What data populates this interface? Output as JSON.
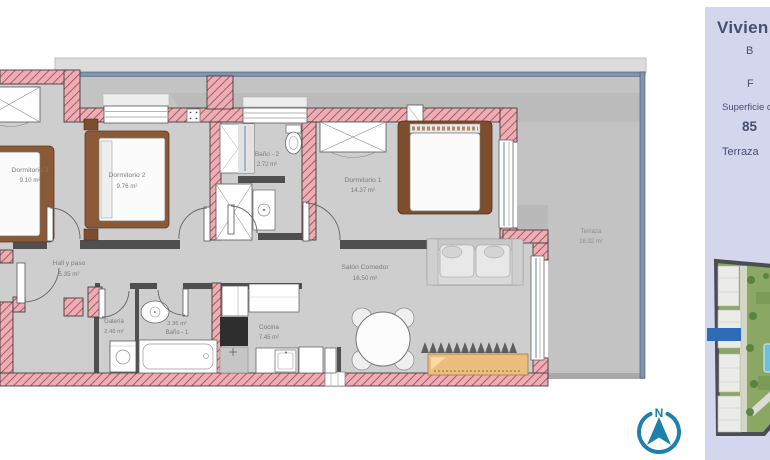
{
  "panel": {
    "title": "Vivien",
    "row1": "B",
    "row2": "F",
    "row3": "Superficie c",
    "row4": "85",
    "row5": "Terraza"
  },
  "compass": {
    "north_label": "N"
  },
  "rooms": {
    "dormitorio3": {
      "name": "Dormitorio 3",
      "area": "9.10 m²"
    },
    "dormitorio2": {
      "name": "Dormitorio 2",
      "area": "9.76 m²"
    },
    "bano2": {
      "name": "Baño - 2",
      "area": "2.72 m²"
    },
    "dormitorio1": {
      "name": "Dormitorio 1",
      "area": "14.37 m²"
    },
    "hall": {
      "name": "Hall y paso",
      "area": "5.35 m²"
    },
    "galeria": {
      "name": "Galería",
      "area": "2.46 m²"
    },
    "bano1": {
      "name": "Baño - 1",
      "area": "3.36 m²"
    },
    "cocina": {
      "name": "Cocina",
      "area": "7.45 m²"
    },
    "salon": {
      "name": "Salón Comedor",
      "area": "16.50 m²"
    },
    "terraza": {
      "name": "Terraza",
      "area": "28.92 m²"
    }
  },
  "colors": {
    "wall_fill": "#f1acb3",
    "terrace_floor": "#c3c3c3",
    "interior_floor": "#cecece",
    "glass_blue": "#7e96af",
    "compass_teal": "#1d80ad",
    "panel_background": "#d4d6ee",
    "panel_title_text": "#22304f",
    "site_highlight_blue": "#2e6cb8"
  }
}
